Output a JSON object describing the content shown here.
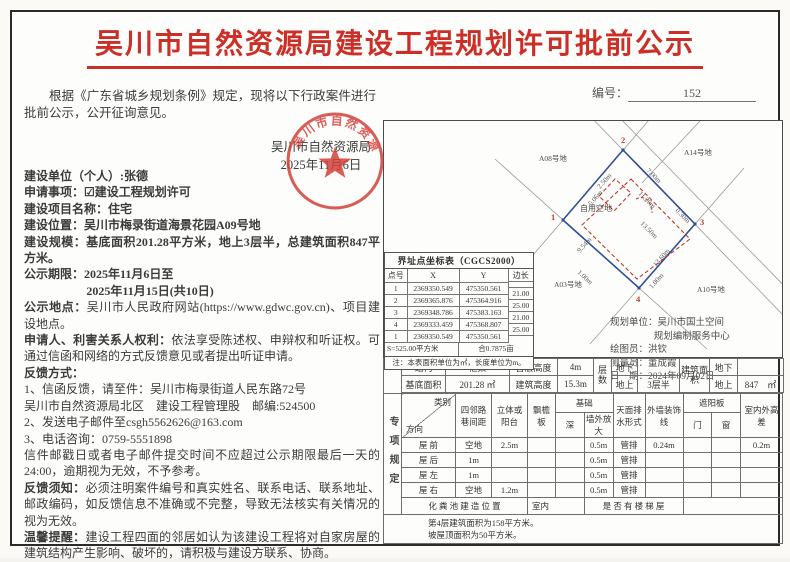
{
  "document": {
    "title": "吴川市自然资源局建设工程规划许可批前公示",
    "number_label": "编号：",
    "number": "152",
    "intro": "根据《广东省城乡规划条例》规定，现将以下行政案件进行批前公示，公开征询意见。",
    "issuer": "吴川市自然资源局",
    "issue_date": "2025年11月6日",
    "seal_text": "吴川市自然资源局"
  },
  "fields": {
    "unit_label": "建设单位（个人）:",
    "unit_value": "张德",
    "matter_label": "申请事项：",
    "matter_value": "☑建设工程规划许可",
    "project_label": "建设项目名称：",
    "project_value": "住宅",
    "location_label": "建设位置：",
    "location_value": "吴川市梅录街道海景花园A09号地",
    "scale_label": "建设规模：",
    "scale_value": "基底面积201.28平方米，地上3层半，总建筑面积847平方米。",
    "period_label": "公示期限：",
    "period_line1": "2025年11月6日至",
    "period_line2": "2025年11月15日(共10日)",
    "place_label": "公示地点：",
    "place_value": "吴川市人民政府网站(https://www.gdwc.gov.cn)、项目建设地点。",
    "rights_label": "申请人、利害关系人权利：",
    "rights_value": "依法享受陈述权、申辩权和听证权。可通过信函和网络的方式反馈意见或者提出听证申请。",
    "feedback_label": "反馈方式：",
    "feedback_mail": "1、信函反馈，请至件：吴川市梅录街道人民东路72号",
    "feedback_mail2": "吴川市自然资源局北区　建设工程管理股　邮编:524500",
    "feedback_email": "2、发送电子邮件至csgh5562626@163.com",
    "feedback_phone": "3、电话咨询：0759-5551898",
    "deadline_note": "信件邮戳日或者电子邮件提交时间不应超过公示期限最后一天的24:00，逾期视为无效，不予参考。",
    "notice_label": "反馈须知：",
    "notice_value": "必须注明案件编号和真实姓名、联系电话、联系地址、邮政编码，如反馈信息不准确或不完整，导致无法核实有关情况的视为无效。",
    "tip_label": "温馨提醒：",
    "tip_value": "建设工程四面的邻居如认为该建设工程将对自家房屋的建筑结构产生影响、破坏的，请积极与建设方联系、协商。"
  },
  "coord_table": {
    "title": "界址点坐标表（CGCS2000）",
    "headers": {
      "no": "点号",
      "x": "X",
      "y": "Y",
      "edge": "边长"
    },
    "rows": [
      {
        "no": "1",
        "x": "2369350.549",
        "y": "475350.561"
      },
      {
        "no": "2",
        "x": "2369365.876",
        "y": "475364.916"
      },
      {
        "no": "3",
        "x": "2369348.786",
        "y": "475383.163"
      },
      {
        "no": "4",
        "x": "2369333.459",
        "y": "475368.807"
      },
      {
        "no": "1",
        "x": "2369350.549",
        "y": "475350.561"
      }
    ],
    "edges": [
      "21.00",
      "25.00",
      "21.00",
      "25.00"
    ],
    "area": "S=525.00平方米",
    "area_mu": "合0.7875亩",
    "note": "注：本表面积单位为㎡，长度单位为m。"
  },
  "site_plan": {
    "open_space": "自用空地",
    "parcel_top_left": "A08号地",
    "parcel_top_right": "A14号地",
    "parcel_bottom_left": "A03号地",
    "parcel_bottom_right": "A10号地",
    "corner_1": "1",
    "corner_2": "2",
    "corner_3": "3",
    "corner_4": "4",
    "dims": {
      "top": "7.00m",
      "ne": "11.20m",
      "gap": "0.30m",
      "inner": "13.50m",
      "nw": "2.50m",
      "notch": "5.06m",
      "west": "9.54m",
      "se": "13.60m",
      "sw_setback": "1.00m",
      "se_setback": "1.00m"
    },
    "credits": {
      "org_label": "规划单位：",
      "org_line1": "吴川市国土空间",
      "org_line2": "规划编制服务中心",
      "drafter_label": "绘图员：",
      "drafter": "洪钦",
      "surveyor_label": "测量员：",
      "surveyor": "董成霞",
      "date_label": "日　期：",
      "date": "2024年09月02日"
    }
  },
  "spec_table": {
    "side_label": "专项规定",
    "row1": {
      "c1": "结构",
      "c2": "框架",
      "c3": "首层高度",
      "c4": "4m",
      "floors": "层数",
      "c5": "地下",
      "c6": "",
      "area_label": "建筑面积",
      "c7": "地下",
      "c8": ""
    },
    "row2": {
      "c1": "基底面积",
      "c2": "201.28 ㎡",
      "c3": "建筑高度",
      "c4": "15.3m",
      "c5": "地上",
      "c6": "3层半",
      "c7": "地上",
      "c8": "847　㎡"
    },
    "header": {
      "corner_top": "类别",
      "corner_bottom": "方向",
      "neighbor": "四邻路巷间距",
      "balcony": "立体或阳台",
      "eave": "飘檐板",
      "foundation": "基础",
      "depth": "深",
      "expand": "墙外放大",
      "drain": "天面排水形式",
      "trim": "外墙装饰线",
      "sunshade": "遮阳板",
      "door": "门",
      "window": "窗",
      "height_diff": "室内外高差"
    },
    "rows": [
      {
        "dir": "屋 前",
        "neighbor": "空地",
        "balcony": "2.5m",
        "eave": "",
        "depth": "",
        "expand": "0.5m",
        "drain": "管排",
        "trim": "0.24m",
        "door": "",
        "window": "",
        "diff": "0.2m"
      },
      {
        "dir": "屋 后",
        "neighbor": "1m",
        "balcony": "",
        "eave": "",
        "depth": "",
        "expand": "0.5m",
        "drain": "管排",
        "trim": "",
        "door": "",
        "window": "",
        "diff": ""
      },
      {
        "dir": "屋 左",
        "neighbor": "1m",
        "balcony": "",
        "eave": "",
        "depth": "",
        "expand": "0.5m",
        "drain": "管排",
        "trim": "",
        "door": "",
        "window": "",
        "diff": ""
      },
      {
        "dir": "屋 右",
        "neighbor": "空地",
        "balcony": "1.2m",
        "eave": "",
        "depth": "",
        "expand": "0.5m",
        "drain": "管排",
        "trim": "",
        "door": "",
        "window": "",
        "diff": ""
      }
    ],
    "septic_label": "化 粪 池 建 造 位 置",
    "septic_value": "室内",
    "stair_label": "是 否 有 楼 梯 屋",
    "stair_value": "",
    "note1": "第4层建筑面积为158平方米。",
    "note2": "坡屋顶面积为50平方米。"
  },
  "colors": {
    "title_red": "#cc2f27",
    "seal_red": "#d4403a",
    "plan_blue": "#2e4f96",
    "plan_red": "#c0392b"
  }
}
